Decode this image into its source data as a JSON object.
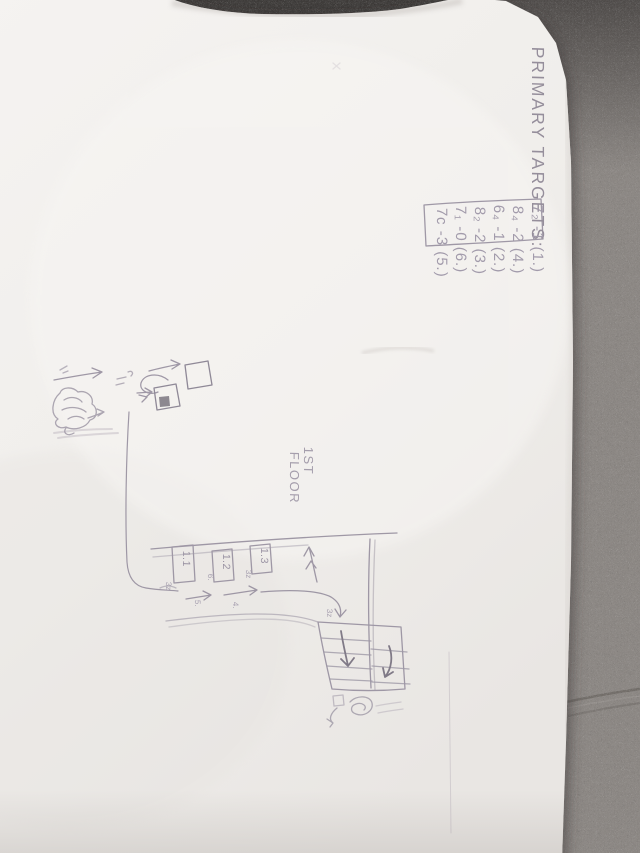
{
  "notes": {
    "heading": "PRIMARY TARGETS:",
    "targets": [
      {
        "text": "7₂ -1 (1.)"
      },
      {
        "text": "8₄ -2 (4.)"
      },
      {
        "text": "6₄ -1 (2.)"
      },
      {
        "text": "8₂ -2 (3.)"
      },
      {
        "text": "7₁ -0 (6.)"
      },
      {
        "text": "7c -3 (5.)"
      }
    ]
  },
  "floor_plan": {
    "floor_label": {
      "line1": "1ST",
      "line2": "FLOOR"
    },
    "rooms": [
      {
        "label": "1.1",
        "note": "3z"
      },
      {
        "label": "1.2",
        "note": "6."
      },
      {
        "label": "1.3",
        "note": "3z"
      }
    ],
    "corridor_marks": [
      {
        "text": "5."
      },
      {
        "text": "4."
      }
    ],
    "stair_mark": "3z"
  },
  "colors": {
    "paper": "#f1efec",
    "fabric": "#8d8884",
    "pencil": "#958e9a"
  }
}
